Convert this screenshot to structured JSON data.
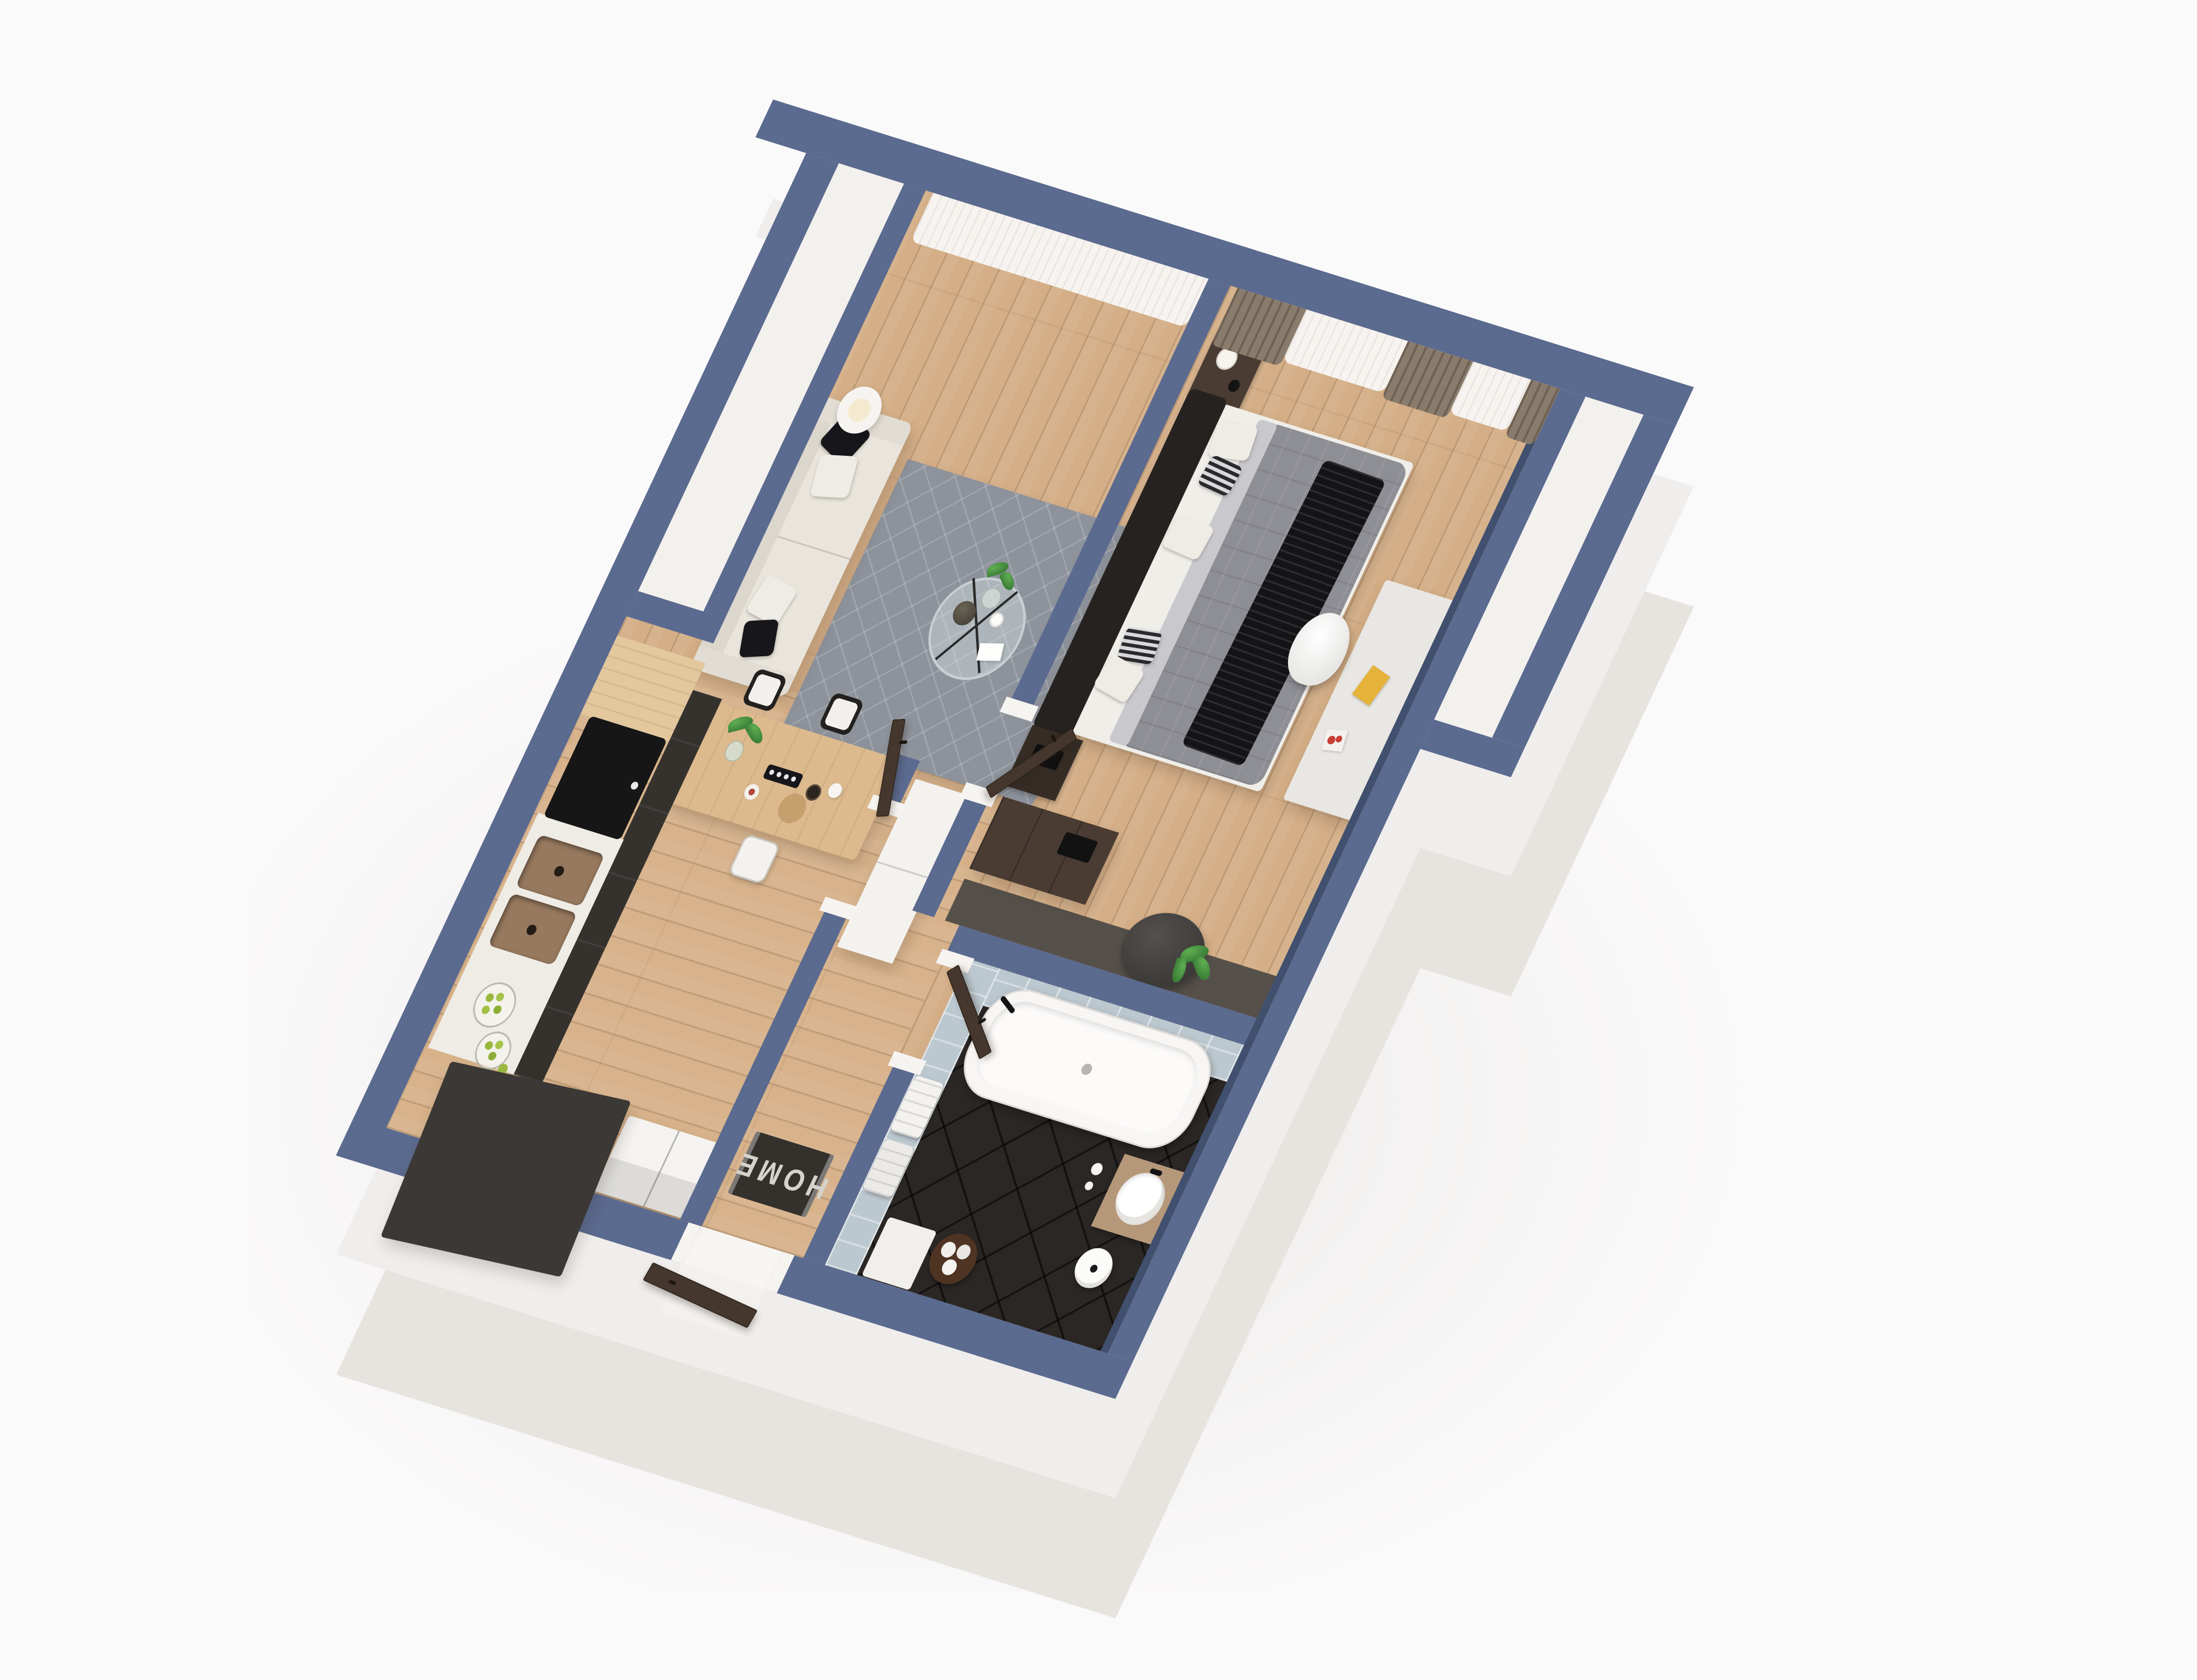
{
  "scene": {
    "type": "3d-floor-plan-render",
    "view": "isometric cutaway, rotated clockwise, viewed from above",
    "background_color": "#fbfafa",
    "palette": {
      "wall_top": "#5b6a8f",
      "wall_inner_shade": "#41506e",
      "slab_side": "#efedeb",
      "wood_floor": "#d4ae86",
      "bathroom_floor_tile": "#2b2725",
      "bathroom_wall_tile": "#bcc8cf",
      "rug": "#8d929b",
      "sofa": "#e9e5dc",
      "door_brown": "#45372d",
      "curtain_brown": "#8a7c6c",
      "cabinet_charcoal": "#35322e",
      "accent_plant": "#3f7d3a"
    }
  },
  "labels": {
    "doormat": "HOME"
  },
  "rooms": [
    {
      "name": "living-room",
      "furniture": [
        "sheer window curtain",
        "floor lamp",
        "cream three-seat sofa",
        "two black pillows",
        "two white pillows",
        "gray quilted rug",
        "round glass coffee table",
        "vase with plant",
        "dark decorative vase",
        "white cup",
        "white magazine"
      ]
    },
    {
      "name": "kitchen-dining",
      "furniture": [
        "wood worktop",
        "charcoal base cabinets",
        "black cooktop",
        "bronze double sink",
        "two glass jars with green fruit",
        "loose green fruit",
        "white counter",
        "charcoal countertop slab",
        "white fridge",
        "wood dining table",
        "two black-frame white chairs",
        "one white chair",
        "plant in glass vase",
        "sushi tray",
        "wine bottle",
        "white jug",
        "dessert plate",
        "wood serving board"
      ]
    },
    {
      "name": "hallway",
      "furniture": [
        "white wardrobe column",
        "HOME doormat",
        "open interior door to hallway",
        "open door to bedroom",
        "entrance threshold",
        "open entrance door"
      ]
    },
    {
      "name": "bedroom",
      "furniture": [
        "brown and sheer curtains",
        "dark nightstand with table lamp",
        "black alarm clock",
        "double bed with black frame",
        "white and striped pillows",
        "gray duvet",
        "black fringed throw",
        "dark nightstand with black tray",
        "dark brown dresser",
        "dark console shelf",
        "gray bean bag",
        "potted plant",
        "white desk",
        "yellow book",
        "red and white cards",
        "white shell desk chair"
      ]
    },
    {
      "name": "bathroom",
      "furniture": [
        "white freestanding bathtub",
        "black faucet",
        "blue-gray wall tiles",
        "dark diagonal floor tiles",
        "wood vanity",
        "round white vessel sink",
        "white toiletries",
        "white stool",
        "brown basket with rolled towels",
        "hanging white towels",
        "white bath mat",
        "open bathroom door"
      ]
    },
    {
      "name": "balcony-strip",
      "furniture": []
    },
    {
      "name": "niche",
      "furniture": []
    }
  ]
}
